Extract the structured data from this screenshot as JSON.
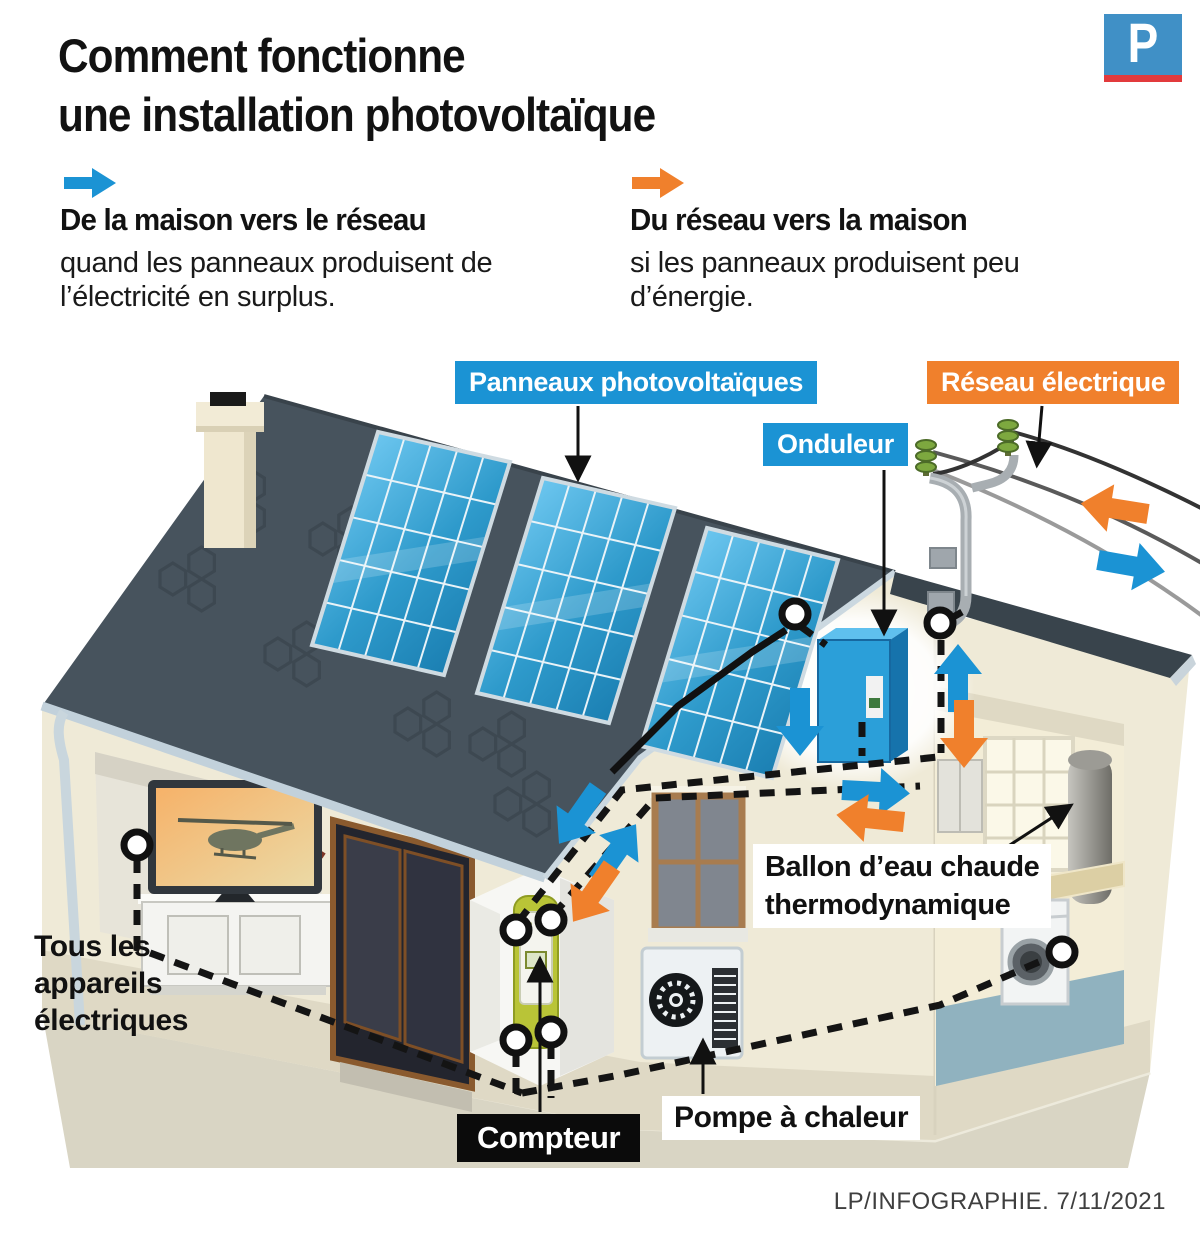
{
  "header": {
    "title_lines": [
      "Comment fonctionne",
      "une installation photovoltaïque"
    ],
    "logo_letter": "P"
  },
  "legend": {
    "to_grid": {
      "title": "De la maison vers le réseau",
      "description": "quand les panneaux produisent de l’électricité en surplus.",
      "arrow_color": "#1B93D4"
    },
    "from_grid": {
      "title": "Du réseau vers la maison",
      "description": "si les panneaux produisent peu d’énergie.",
      "arrow_color": "#F0802C"
    }
  },
  "diagram": {
    "labels": {
      "solar_panels": "Panneaux photovoltaïques",
      "grid": "Réseau électrique",
      "inverter": "Onduleur",
      "water_heater_lines": [
        "Ballon d’eau chaude",
        "thermodynamique"
      ],
      "meter": "Compteur",
      "heat_pump": "Pompe à chaleur",
      "appliances_lines": [
        "Tous les",
        "appareils",
        "électriques"
      ]
    },
    "colors": {
      "flow_export_blue": "#1B93D4",
      "flow_import_orange": "#F0802C",
      "roof": "#47535D",
      "wall": "#EFEAD7",
      "label_blue_bg": "#1B93D4",
      "label_orange_bg": "#F0802C",
      "label_black_bg": "#0B0B0B",
      "logo_blue": "#4090C6",
      "logo_red": "#E23A3C"
    }
  },
  "footer": {
    "credit": "LP/INFOGRAPHIE.  7/11/2021"
  }
}
